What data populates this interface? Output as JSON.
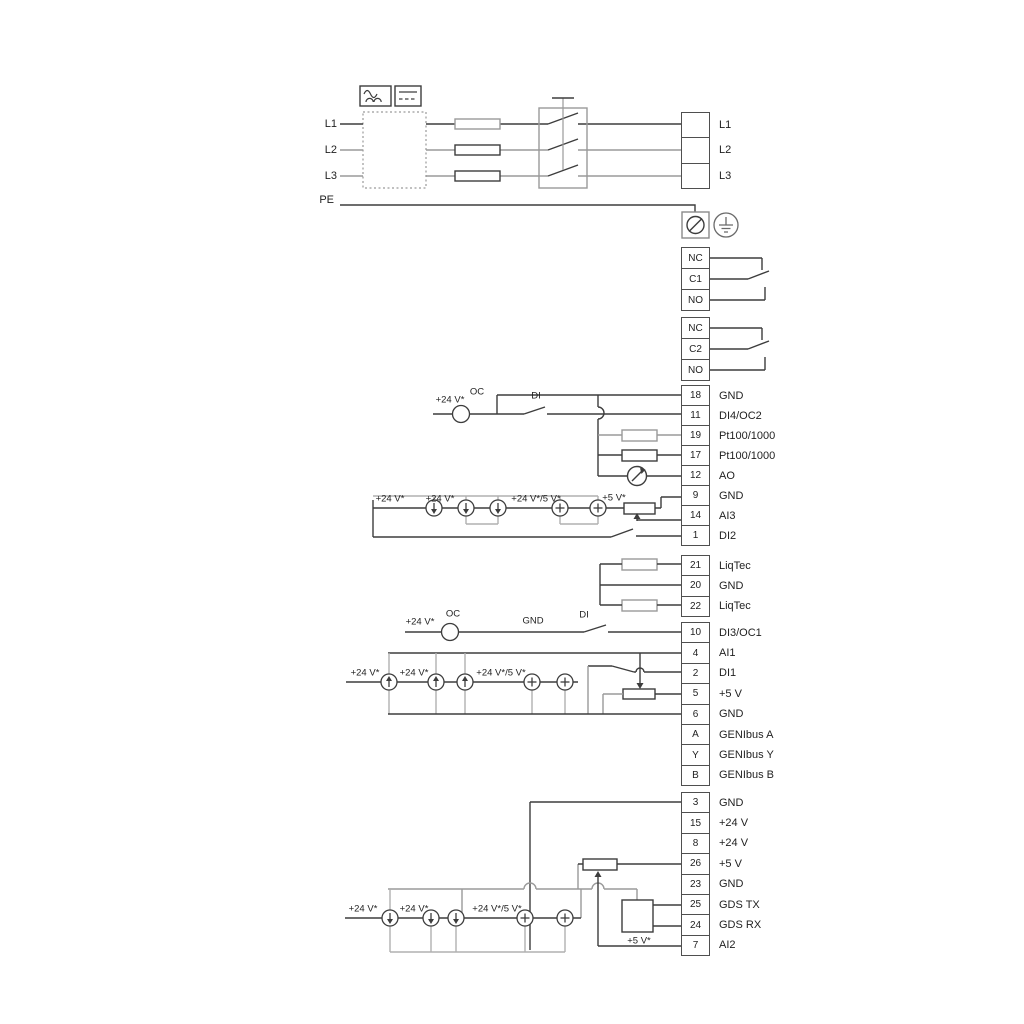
{
  "diagram": {
    "kind": "pump-drive wiring diagram",
    "colors": {
      "line_dark": "#3d3d3d",
      "line_gray": "#a3a3a3",
      "text": "#1f1f1f",
      "background": "#ffffff"
    }
  },
  "mains": {
    "l1": "L1",
    "l2": "L2",
    "l3": "L3",
    "pe": "PE",
    "output_block": [
      {
        "no": "",
        "label": "L1"
      },
      {
        "no": "",
        "label": "L2"
      },
      {
        "no": "",
        "label": "L3"
      }
    ]
  },
  "relay1": [
    {
      "no": "NC"
    },
    {
      "no": "C1"
    },
    {
      "no": "NO"
    }
  ],
  "relay2": [
    {
      "no": "NC"
    },
    {
      "no": "C2"
    },
    {
      "no": "NO"
    }
  ],
  "io_a": [
    {
      "no": "18",
      "label": "GND"
    },
    {
      "no": "11",
      "label": "DI4/OC2"
    },
    {
      "no": "19",
      "label": "Pt100/1000"
    },
    {
      "no": "17",
      "label": "Pt100/1000"
    },
    {
      "no": "12",
      "label": "AO"
    },
    {
      "no": "9",
      "label": "GND"
    },
    {
      "no": "14",
      "label": "AI3"
    },
    {
      "no": "1",
      "label": "DI2"
    }
  ],
  "io_b": [
    {
      "no": "21",
      "label": "LiqTec"
    },
    {
      "no": "20",
      "label": "GND"
    },
    {
      "no": "22",
      "label": "LiqTec"
    }
  ],
  "io_c": [
    {
      "no": "10",
      "label": "DI3/OC1"
    },
    {
      "no": "4",
      "label": "AI1"
    },
    {
      "no": "2",
      "label": "DI1"
    },
    {
      "no": "5",
      "label": "+5 V"
    },
    {
      "no": "6",
      "label": "GND"
    },
    {
      "no": "A",
      "label": "GENIbus A"
    },
    {
      "no": "Y",
      "label": "GENIbus Y"
    },
    {
      "no": "B",
      "label": "GENIbus B"
    }
  ],
  "io_d": [
    {
      "no": "3",
      "label": "GND"
    },
    {
      "no": "15",
      "label": "+24 V"
    },
    {
      "no": "8",
      "label": "+24 V"
    },
    {
      "no": "26",
      "label": "+5 V"
    },
    {
      "no": "23",
      "label": "GND"
    },
    {
      "no": "25",
      "label": "GDS TX"
    },
    {
      "no": "24",
      "label": "GDS RX"
    },
    {
      "no": "7",
      "label": "AI2"
    }
  ],
  "ann": {
    "plus24": "+24 V*",
    "oc": "OC",
    "di": "DI",
    "gnd": "GND",
    "plus24_5": "+24 V*/5 V*",
    "plus5": "+5 V*"
  }
}
